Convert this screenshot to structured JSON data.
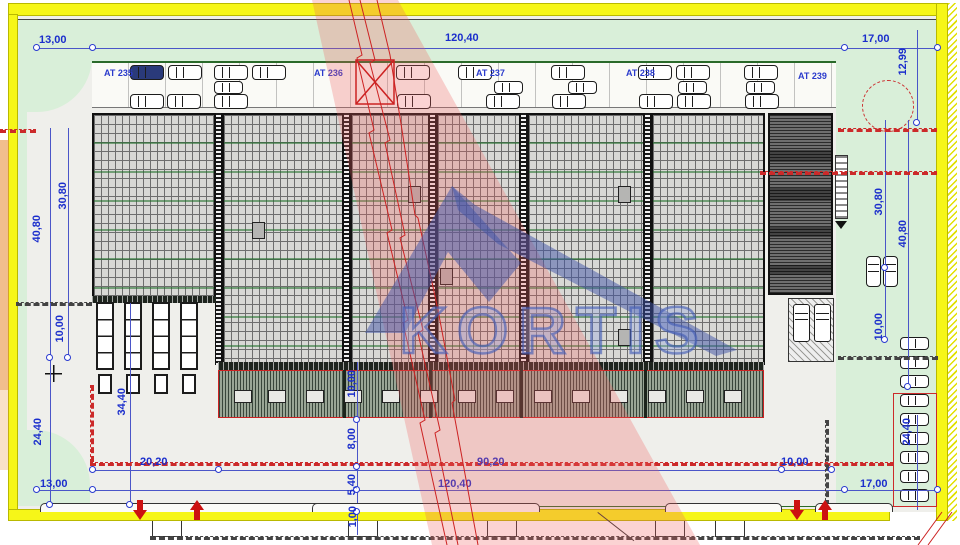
{
  "watermark": {
    "logo_text": "KORTIS"
  },
  "colors": {
    "dimension_blue": "#2233cc",
    "boundary_yellow": "#f6f618",
    "site_green": "#d9efd9",
    "red_accent": "#cc2a2a",
    "logo_blue": "#4a63b8",
    "roof_gray": "#d8d8d5"
  },
  "parking_zone_labels": [
    {
      "text": "AT 235",
      "x": 104,
      "y": 68
    },
    {
      "text": "AT 236",
      "x": 314,
      "y": 68
    },
    {
      "text": "AT 237",
      "x": 476,
      "y": 68
    },
    {
      "text": "AT 238",
      "x": 626,
      "y": 68
    },
    {
      "text": "AT 239",
      "x": 798,
      "y": 71
    }
  ],
  "dimension_labels": [
    {
      "text": "13,00",
      "x": 39,
      "y": 35
    },
    {
      "text": "120,40",
      "x": 445,
      "y": 33
    },
    {
      "text": "17,00",
      "x": 862,
      "y": 34
    },
    {
      "text": "12,99",
      "x": 898,
      "y": 48,
      "cls": "v"
    },
    {
      "text": "40,80",
      "x": 32,
      "y": 215,
      "cls": "v"
    },
    {
      "text": "30,80",
      "x": 58,
      "y": 182,
      "cls": "v"
    },
    {
      "text": "10,00",
      "x": 55,
      "y": 315,
      "cls": "v"
    },
    {
      "text": "24,40",
      "x": 33,
      "y": 418,
      "cls": "v"
    },
    {
      "text": "34,40",
      "x": 117,
      "y": 388,
      "cls": "v"
    },
    {
      "text": "13,00",
      "x": 40,
      "y": 479
    },
    {
      "text": "20,20",
      "x": 140,
      "y": 457
    },
    {
      "text": "90,20",
      "x": 477,
      "y": 457
    },
    {
      "text": "120,40",
      "x": 438,
      "y": 479
    },
    {
      "text": "10,00",
      "x": 781,
      "y": 457
    },
    {
      "text": "17,00",
      "x": 860,
      "y": 479
    },
    {
      "text": "10,00",
      "x": 347,
      "y": 370,
      "cls": "v"
    },
    {
      "text": "8,00",
      "x": 347,
      "y": 428,
      "cls": "v"
    },
    {
      "text": "5,40",
      "x": 347,
      "y": 474,
      "cls": "v"
    },
    {
      "text": "1,00",
      "x": 348,
      "y": 506,
      "cls": "v"
    },
    {
      "text": "30,80",
      "x": 874,
      "y": 188,
      "cls": "v"
    },
    {
      "text": "40,80",
      "x": 898,
      "y": 220,
      "cls": "v"
    },
    {
      "text": "10,00",
      "x": 874,
      "y": 313,
      "cls": "v"
    },
    {
      "text": "24,40",
      "x": 902,
      "y": 418,
      "cls": "v"
    }
  ],
  "lines": [
    {
      "x": 37,
      "y": 48,
      "w": 901,
      "cls": "hline c-blue"
    },
    {
      "x": 50,
      "y": 128,
      "h": 377,
      "cls": "vline c-blue"
    },
    {
      "x": 68,
      "y": 128,
      "h": 230,
      "cls": "vline c-blue"
    },
    {
      "x": 130,
      "y": 303,
      "h": 205,
      "cls": "vline c-blue"
    },
    {
      "x": 93,
      "y": 470,
      "w": 739,
      "cls": "hline c-blue"
    },
    {
      "x": 37,
      "y": 490,
      "w": 901,
      "cls": "hline c-blue"
    },
    {
      "x": 357,
      "y": 362,
      "h": 173,
      "cls": "vline c-blue"
    },
    {
      "x": 885,
      "y": 120,
      "h": 222,
      "cls": "vline c-blue"
    },
    {
      "x": 908,
      "y": 120,
      "h": 267,
      "cls": "vline c-blue"
    },
    {
      "x": 917,
      "y": 30,
      "h": 95,
      "cls": "vline c-blue"
    },
    {
      "x": 917,
      "y": 415,
      "h": 95,
      "cls": "vline c-blue"
    },
    {
      "x": 92,
      "y": 61,
      "w": 744,
      "cls": "hline c-green thick"
    },
    {
      "x": 315,
      "y": 506,
      "w": 602,
      "cls": "hline c-green"
    },
    {
      "x": 18,
      "y": 19,
      "w": 918,
      "cls": "hline c-dark"
    },
    {
      "x": 90,
      "y": 385,
      "h": 77,
      "cls": "vline c-red dash"
    },
    {
      "x": 90,
      "y": 462,
      "w": 803,
      "cls": "hline c-red dash"
    },
    {
      "x": 838,
      "y": 128,
      "w": 99,
      "cls": "hline c-red dash"
    },
    {
      "x": 760,
      "y": 171,
      "w": 177,
      "cls": "hline c-red dash"
    },
    {
      "x": 0,
      "y": 129,
      "w": 36,
      "cls": "hline c-red dash"
    },
    {
      "x": 16,
      "y": 302,
      "w": 76,
      "cls": "hline c-dark dash"
    },
    {
      "x": 825,
      "y": 420,
      "h": 86,
      "cls": "vline c-dark dash"
    },
    {
      "x": 838,
      "y": 356,
      "w": 100,
      "cls": "hline c-dark dash"
    },
    {
      "x": 150,
      "y": 536,
      "w": 770,
      "cls": "hline c-dark dash"
    }
  ],
  "markers": [
    {
      "x": 37,
      "y": 48
    },
    {
      "x": 93,
      "y": 48
    },
    {
      "x": 845,
      "y": 48
    },
    {
      "x": 938,
      "y": 48
    },
    {
      "x": 93,
      "y": 470
    },
    {
      "x": 219,
      "y": 470
    },
    {
      "x": 782,
      "y": 470
    },
    {
      "x": 832,
      "y": 470
    },
    {
      "x": 37,
      "y": 490
    },
    {
      "x": 93,
      "y": 490
    },
    {
      "x": 845,
      "y": 490
    },
    {
      "x": 938,
      "y": 490
    },
    {
      "x": 50,
      "y": 358
    },
    {
      "x": 68,
      "y": 358
    },
    {
      "x": 50,
      "y": 505
    },
    {
      "x": 130,
      "y": 505
    },
    {
      "x": 885,
      "y": 268
    },
    {
      "x": 885,
      "y": 340
    },
    {
      "x": 908,
      "y": 387
    },
    {
      "x": 917,
      "y": 123
    },
    {
      "x": 357,
      "y": 420
    },
    {
      "x": 357,
      "y": 467
    },
    {
      "x": 357,
      "y": 490
    },
    {
      "x": 357,
      "y": 512
    }
  ],
  "building_joints": [
    {
      "x": 215,
      "y": 113,
      "h": 252
    },
    {
      "x": 343,
      "y": 113,
      "h": 252
    },
    {
      "x": 429,
      "y": 113,
      "h": 252
    },
    {
      "x": 520,
      "y": 113,
      "h": 252
    },
    {
      "x": 644,
      "y": 113,
      "h": 252
    }
  ],
  "roof_hatches": [
    {
      "x": 252,
      "y": 222
    },
    {
      "x": 408,
      "y": 186
    },
    {
      "x": 440,
      "y": 268
    },
    {
      "x": 618,
      "y": 186
    },
    {
      "x": 618,
      "y": 329
    }
  ],
  "vehicles": {
    "cars_top": [
      {
        "x": 130,
        "y": 65,
        "cls": "filled"
      },
      {
        "x": 168,
        "y": 65
      },
      {
        "x": 214,
        "y": 65
      },
      {
        "x": 252,
        "y": 65
      },
      {
        "x": 396,
        "y": 65
      },
      {
        "x": 458,
        "y": 65
      },
      {
        "x": 551,
        "y": 65
      },
      {
        "x": 638,
        "y": 65
      },
      {
        "x": 676,
        "y": 65
      },
      {
        "x": 744,
        "y": 65
      },
      {
        "x": 214,
        "y": 81,
        "cls": "small"
      },
      {
        "x": 494,
        "y": 81,
        "cls": "small"
      },
      {
        "x": 568,
        "y": 81,
        "cls": "small"
      },
      {
        "x": 678,
        "y": 81,
        "cls": "small"
      },
      {
        "x": 746,
        "y": 81,
        "cls": "small"
      },
      {
        "x": 130,
        "y": 94
      },
      {
        "x": 167,
        "y": 94
      },
      {
        "x": 214,
        "y": 94
      },
      {
        "x": 397,
        "y": 94
      },
      {
        "x": 486,
        "y": 94
      },
      {
        "x": 552,
        "y": 94
      },
      {
        "x": 639,
        "y": 94
      },
      {
        "x": 677,
        "y": 94
      },
      {
        "x": 745,
        "y": 94
      }
    ],
    "cars_right_col": [
      {
        "x": 900,
        "y": 337,
        "cls": "small"
      },
      {
        "x": 900,
        "y": 356,
        "cls": "small"
      },
      {
        "x": 900,
        "y": 375,
        "cls": "small"
      },
      {
        "x": 900,
        "y": 394,
        "cls": "small"
      },
      {
        "x": 900,
        "y": 413,
        "cls": "small"
      },
      {
        "x": 900,
        "y": 432,
        "cls": "small"
      },
      {
        "x": 900,
        "y": 451,
        "cls": "small"
      },
      {
        "x": 900,
        "y": 470,
        "cls": "small"
      },
      {
        "x": 900,
        "y": 489,
        "cls": "small"
      }
    ],
    "cars_right_pair": [
      {
        "x": 866,
        "y": 256,
        "cls": "v"
      },
      {
        "x": 883,
        "y": 256,
        "cls": "v"
      }
    ],
    "vans": [
      {
        "x": 793,
        "y": 304
      },
      {
        "x": 814,
        "y": 304
      }
    ],
    "trucks": [
      {
        "x": 96,
        "y": 302
      },
      {
        "x": 124,
        "y": 302
      },
      {
        "x": 152,
        "y": 302
      },
      {
        "x": 180,
        "y": 302
      }
    ]
  },
  "trailer_slots": [
    {
      "x": 234
    },
    {
      "x": 268
    },
    {
      "x": 306
    },
    {
      "x": 344
    },
    {
      "x": 382
    },
    {
      "x": 420
    },
    {
      "x": 458
    },
    {
      "x": 496
    },
    {
      "x": 534
    },
    {
      "x": 572
    },
    {
      "x": 610
    },
    {
      "x": 648
    },
    {
      "x": 686
    },
    {
      "x": 724
    }
  ],
  "bay_dividers": [
    {
      "x": 343
    },
    {
      "x": 429
    },
    {
      "x": 520
    },
    {
      "x": 644
    }
  ],
  "entrance_arrows": [
    {
      "x": 133,
      "y": 500,
      "cls": "down"
    },
    {
      "x": 190,
      "y": 500,
      "cls": "up"
    },
    {
      "x": 790,
      "y": 500,
      "cls": "down"
    },
    {
      "x": 818,
      "y": 500,
      "cls": "up"
    }
  ],
  "curbs": [
    {
      "x": 40,
      "y": 503,
      "w": 292
    },
    {
      "x": 312,
      "y": 503,
      "w": 228
    },
    {
      "x": 665,
      "y": 503,
      "w": 117
    },
    {
      "x": 815,
      "y": 503,
      "w": 78
    }
  ],
  "road_stubs": [
    {
      "x": 152
    },
    {
      "x": 348
    },
    {
      "x": 487
    },
    {
      "x": 655
    },
    {
      "x": 715
    }
  ]
}
